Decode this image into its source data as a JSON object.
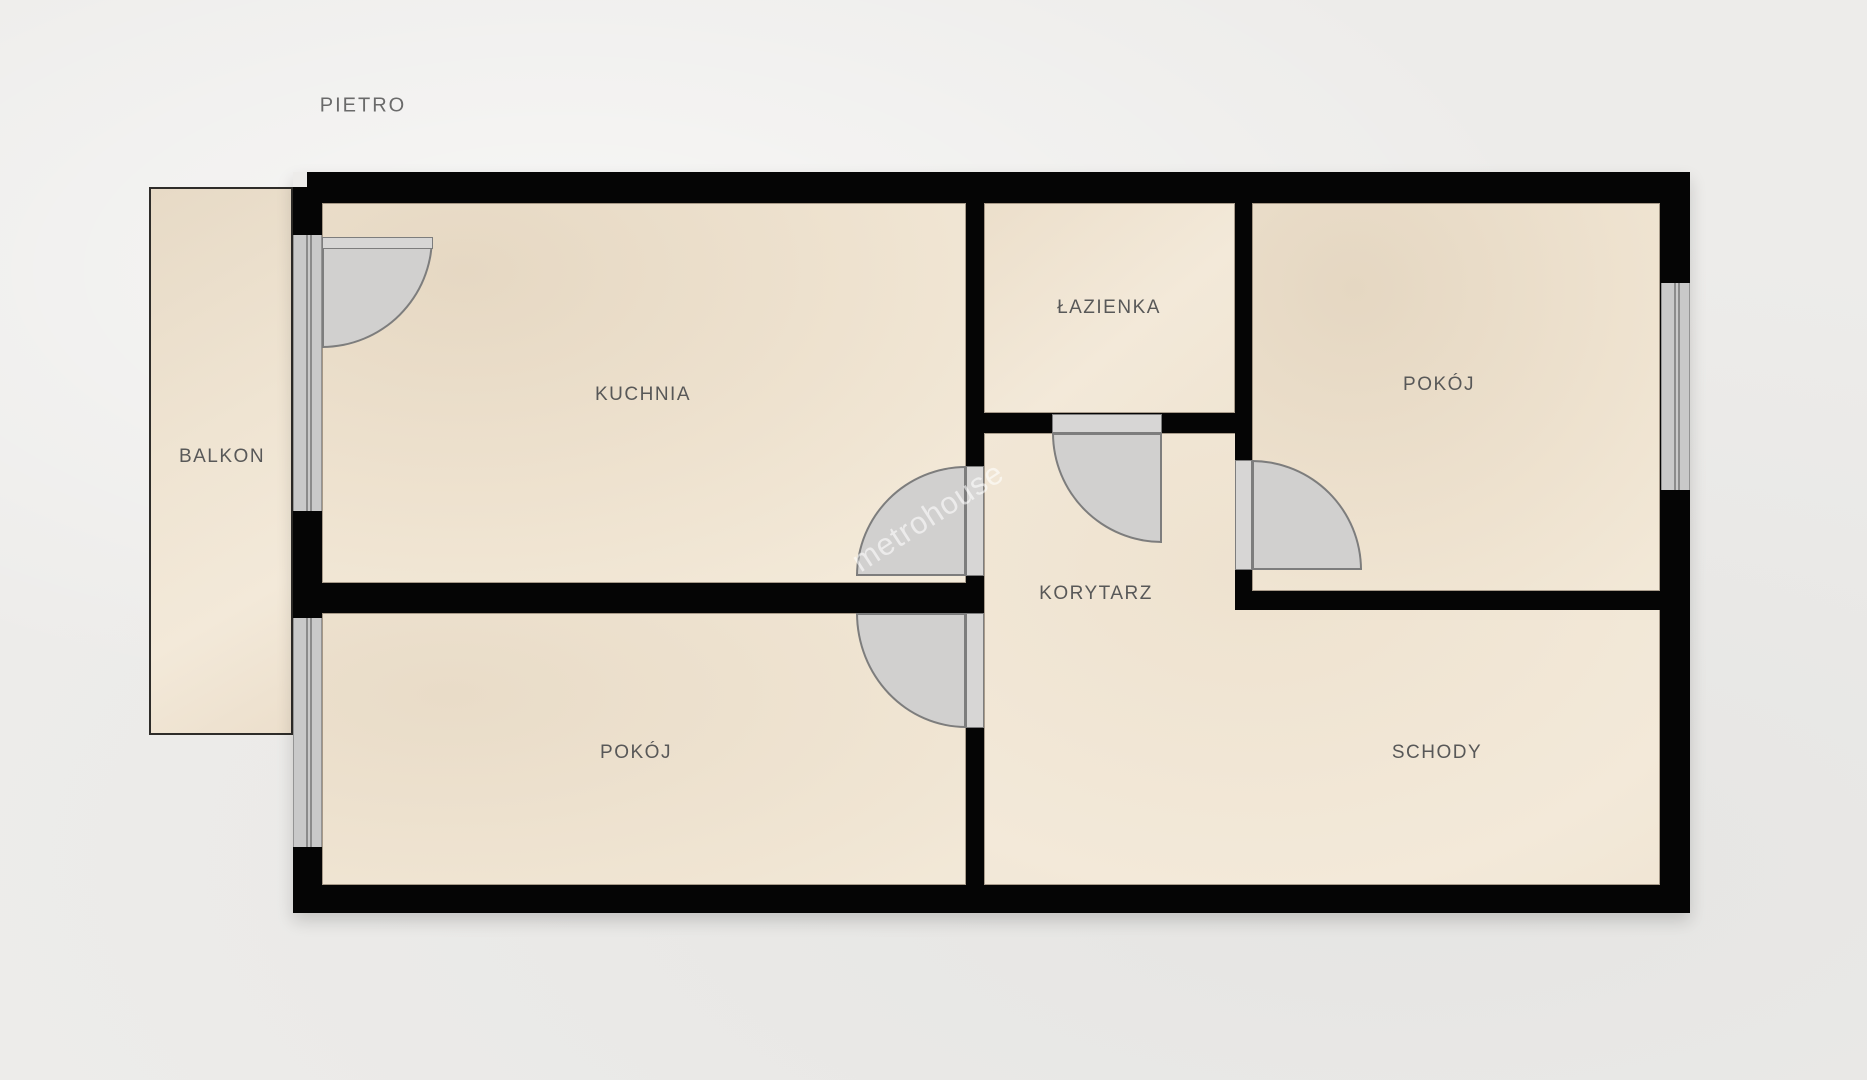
{
  "title": "PIETRO",
  "watermark": "metrohouse",
  "rooms": {
    "balkon": {
      "label": "BALKON"
    },
    "kuchnia": {
      "label": "KUCHNIA"
    },
    "lazienka": {
      "label": "ŁAZIENKA"
    },
    "pokoj_top": {
      "label": "POKÓJ"
    },
    "korytarz": {
      "label": "KORYTARZ"
    },
    "pokoj_bottom": {
      "label": "POKÓJ"
    },
    "schody": {
      "label": "SCHODY"
    }
  },
  "colors": {
    "background": "#edecea",
    "wall": "#050505",
    "floor": "#f0e5d3",
    "floor_dark": "#e6d8c3",
    "window": "#c9c9c9",
    "door": "#d1d0cf",
    "door_outline": "#7d7d7d",
    "label_text": "#585858",
    "balcony_border": "#2e2c29",
    "watermark_text": "rgba(255,255,255,0.58)"
  }
}
